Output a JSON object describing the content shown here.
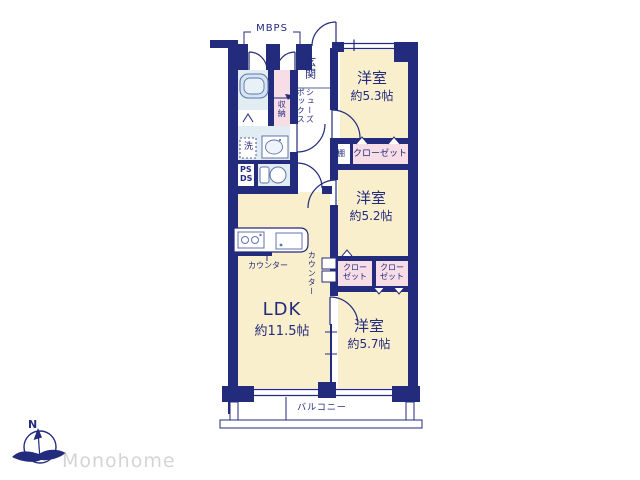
{
  "plan": {
    "colors": {
      "wall": "#232b7d",
      "room_fill": "#f9efcd",
      "closet_fill": "#f7dee6",
      "wet_fill": "#e2ecf3",
      "fixture_stroke": "#6074ad",
      "logo_gray": "#d4d4d4"
    },
    "labels": {
      "mbps": "MBPS",
      "genkan": "玄関",
      "shoes_line1": "シューズ",
      "shoes_line2": "ボックス",
      "storage": "収納",
      "laundry": "洗",
      "ps": "PS",
      "ds": "DS",
      "shelf": "棚",
      "closet_full": "クローゼット",
      "closet_s1": "クロー",
      "closet_s2": "ゼット",
      "counter": "カウンター",
      "balcony": "バルコニー"
    },
    "rooms": {
      "west53": {
        "name": "洋室",
        "size": "約5.3帖"
      },
      "west52": {
        "name": "洋室",
        "size": "約5.2帖"
      },
      "west57": {
        "name": "洋室",
        "size": "約5.7帖"
      },
      "ldk": {
        "name": "LDK",
        "size": "約11.5帖"
      }
    }
  },
  "logo": {
    "brand": "Monohome",
    "north": "N"
  }
}
